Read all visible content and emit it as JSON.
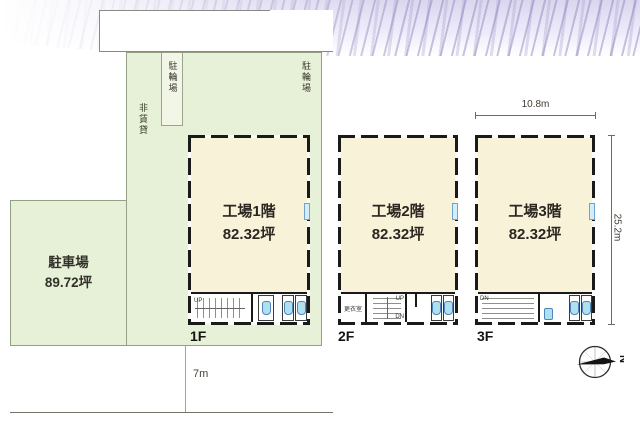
{
  "site": {
    "parking_label": "駐車場",
    "parking_area": "89.72坪",
    "bicycle_label_left": "駐輪場",
    "bicycle_label_right": "駐輪場",
    "non_leased_label": "非賃貸"
  },
  "floors": [
    {
      "tag": "1F",
      "title": "工場1階",
      "area": "82.32坪",
      "stair_note": "UP"
    },
    {
      "tag": "2F",
      "title": "工場2階",
      "area": "82.32坪",
      "room_label": "更衣室",
      "stair_up": "UP",
      "stair_dn": "DN"
    },
    {
      "tag": "3F",
      "title": "工場3階",
      "area": "82.32坪",
      "stair_dn": "DN"
    }
  ],
  "dimensions": {
    "frontage": "10.8m",
    "depth": "25.2m",
    "road": "7m"
  },
  "compass": {
    "north_label": "N"
  },
  "colors": {
    "site_green": "#e7f1d7",
    "floor_cream": "#f8f2d9",
    "fixture_blue": "#aee0f2",
    "band_lavender": "#c5c0de"
  }
}
